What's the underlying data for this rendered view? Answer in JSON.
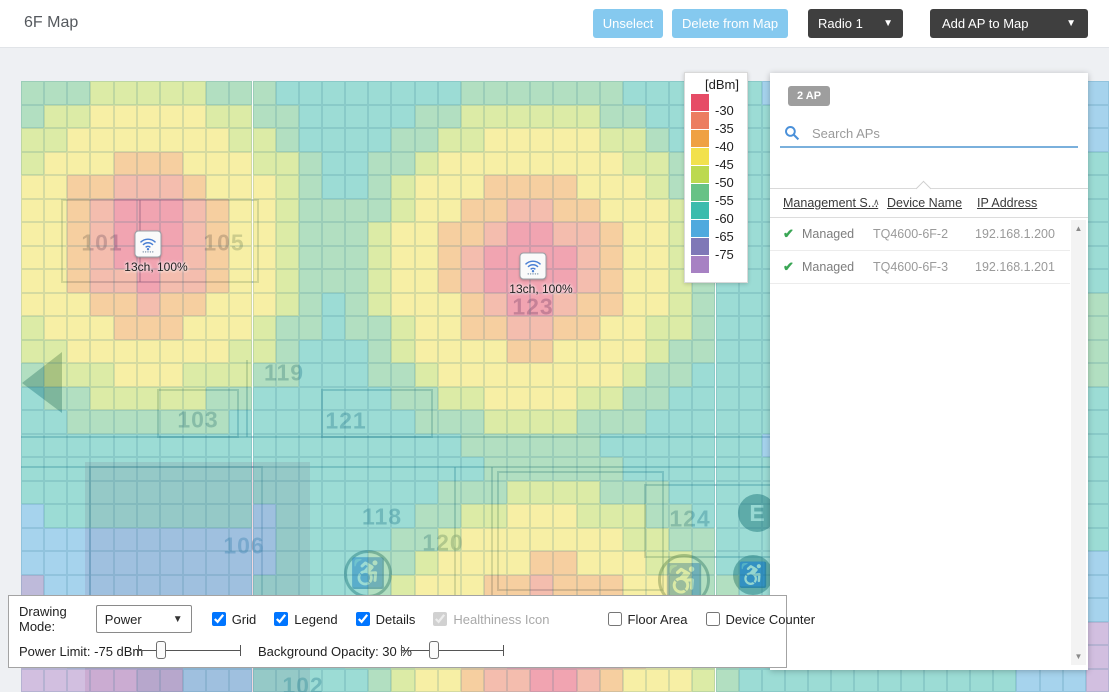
{
  "header": {
    "title": "6F Map",
    "caret": "▼",
    "buttons": [
      {
        "label": "Unselect"
      },
      {
        "label": "Delete from Map"
      },
      {
        "label": "Radio 1"
      },
      {
        "label": "Add AP to Map"
      }
    ],
    "colors": {
      "accent_blue": "#85c9ef",
      "dark": "#3f3f3f"
    }
  },
  "legend": {
    "title": "[dBm]",
    "entries": [
      {
        "color": "#e64c66",
        "label": "-30"
      },
      {
        "color": "#ec7d60",
        "label": "-35"
      },
      {
        "color": "#efa143",
        "label": "-40"
      },
      {
        "color": "#f2e14d",
        "label": "-45"
      },
      {
        "color": "#bcd94f",
        "label": "-50"
      },
      {
        "color": "#67c286",
        "label": "-55"
      },
      {
        "color": "#3cbcad",
        "label": "-60"
      },
      {
        "color": "#4fa9de",
        "label": "-65"
      },
      {
        "color": "#7f78b7",
        "label": "-75"
      },
      {
        "color": "#a781c3",
        "label": ""
      }
    ]
  },
  "ap_panel": {
    "count_badge": "2 AP",
    "search_placeholder": "Search APs",
    "columns": {
      "management": "Management S...",
      "device": "Device Name",
      "ip": "IP Address"
    },
    "sort_indicator": "∧",
    "check_glyph": "✔",
    "scrollbar": {
      "up": "▲",
      "down": "▼"
    },
    "rows": [
      {
        "status": "Managed",
        "name": "TQ4600-6F-2",
        "ip": "192.168.1.200"
      },
      {
        "status": "Managed",
        "name": "TQ4600-6F-3",
        "ip": "192.168.1.201"
      }
    ]
  },
  "map": {
    "rooms": [
      {
        "label": "101",
        "x": 102,
        "y": 243
      },
      {
        "label": "105",
        "x": 224,
        "y": 243
      },
      {
        "label": "123",
        "x": 533,
        "y": 307
      },
      {
        "label": "119",
        "x": 284,
        "y": 373
      },
      {
        "label": "103",
        "x": 198,
        "y": 420
      },
      {
        "label": "121",
        "x": 346,
        "y": 421
      },
      {
        "label": "118",
        "x": 382,
        "y": 517
      },
      {
        "label": "120",
        "x": 443,
        "y": 543
      },
      {
        "label": "106",
        "x": 244,
        "y": 546
      },
      {
        "label": "124",
        "x": 690,
        "y": 519
      },
      {
        "label": "102",
        "x": 303,
        "y": 686
      }
    ],
    "aps": [
      {
        "x": 148,
        "y": 244,
        "label": "13ch, 100%"
      },
      {
        "x": 533,
        "y": 266,
        "label": "13ch, 100%"
      }
    ],
    "floor_icons": [
      {
        "glyph": "E",
        "x": 757,
        "y": 513,
        "r": 19,
        "filled": true,
        "name": "elevator-icon"
      },
      {
        "glyph": "♿",
        "x": 753,
        "y": 575,
        "r": 20,
        "filled": true,
        "name": "accessible-icon"
      },
      {
        "glyph": "♿",
        "x": 368,
        "y": 574,
        "r": 24,
        "filled": false,
        "name": "accessible-icon"
      },
      {
        "glyph": "♿",
        "x": 684,
        "y": 580,
        "r": 26,
        "filled": false,
        "name": "accessible-icon"
      }
    ],
    "heat": {
      "origin": {
        "x": 21,
        "y": 81
      },
      "cols": 47,
      "rows": 26,
      "cell_w": 23.15,
      "cell_h": 23.5,
      "alpha": 0.5,
      "sources": [
        {
          "x": 148,
          "y": 244
        },
        {
          "x": 533,
          "y": 266
        },
        {
          "x": 548,
          "y": 648
        }
      ],
      "bands": [
        {
          "max": 42,
          "color": "#e64c66"
        },
        {
          "max": 64,
          "color": "#ec7d60"
        },
        {
          "max": 90,
          "color": "#efa143"
        },
        {
          "max": 138,
          "color": "#f2e14d"
        },
        {
          "max": 162,
          "color": "#bcd94f"
        },
        {
          "max": 192,
          "color": "#67c286"
        },
        {
          "max": 295,
          "color": "#3cbcad"
        },
        {
          "max": 360,
          "color": "#4fa9de"
        },
        {
          "max": 420,
          "color": "#7f78b7"
        },
        {
          "max": 99999,
          "color": "#a781c3"
        }
      ],
      "overrides": [
        [
          1085,
          81,
          1109,
          140,
          "#4fa9de"
        ],
        [
          752,
          81,
          772,
          150,
          "#4fa9de"
        ],
        [
          1085,
          140,
          1109,
          300,
          "#3cbcad"
        ],
        [
          1085,
          300,
          1109,
          390,
          "#67c286"
        ],
        [
          1085,
          390,
          1109,
          555,
          "#3cbcad"
        ],
        [
          1085,
          555,
          1109,
          610,
          "#4fa9de"
        ],
        [
          1085,
          610,
          1109,
          692,
          "#a781c3"
        ],
        [
          788,
          668,
          1020,
          692,
          "#3cbcad"
        ],
        [
          1020,
          668,
          1085,
          692,
          "#4fa9de"
        ]
      ]
    },
    "walls": {
      "lines": [
        [
          0,
          356,
          1067,
          356
        ],
        [
          0,
          386,
          1067,
          386
        ],
        [
          226,
          279,
          226,
          356
        ],
        [
          119,
          119,
          119,
          201
        ],
        [
          434,
          386,
          434,
          560
        ],
        [
          471,
          386,
          471,
          560
        ]
      ],
      "rects": [
        [
          41,
          119,
          196,
          82
        ],
        [
          137,
          309,
          80,
          47
        ],
        [
          301,
          309,
          110,
          47
        ],
        [
          477,
          391,
          165,
          118
        ],
        [
          624,
          404,
          130,
          72
        ],
        [
          69,
          386,
          172,
          130
        ]
      ],
      "arrow_points": "1,302 41,271 41,332",
      "tint": [
        64,
        381,
        225,
        231
      ]
    }
  },
  "controls": {
    "drawing_mode_label": "Drawing Mode:",
    "drawing_mode_value": "Power",
    "select_caret": "▼",
    "checkboxes": [
      {
        "label": "Grid",
        "checked": true,
        "disabled": false
      },
      {
        "label": "Legend",
        "checked": true,
        "disabled": false
      },
      {
        "label": "Details",
        "checked": true,
        "disabled": false
      },
      {
        "label": "Healthiness Icon",
        "checked": true,
        "disabled": true
      },
      {
        "label": "Floor Area",
        "checked": false,
        "disabled": false,
        "gap": true
      },
      {
        "label": "Device Counter",
        "checked": false,
        "disabled": false
      }
    ],
    "power_limit": {
      "label": "Power Limit: -75 dBm",
      "pct": 22
    },
    "background_opacity": {
      "label": "Background Opacity: 30 %",
      "pct": 32
    }
  }
}
